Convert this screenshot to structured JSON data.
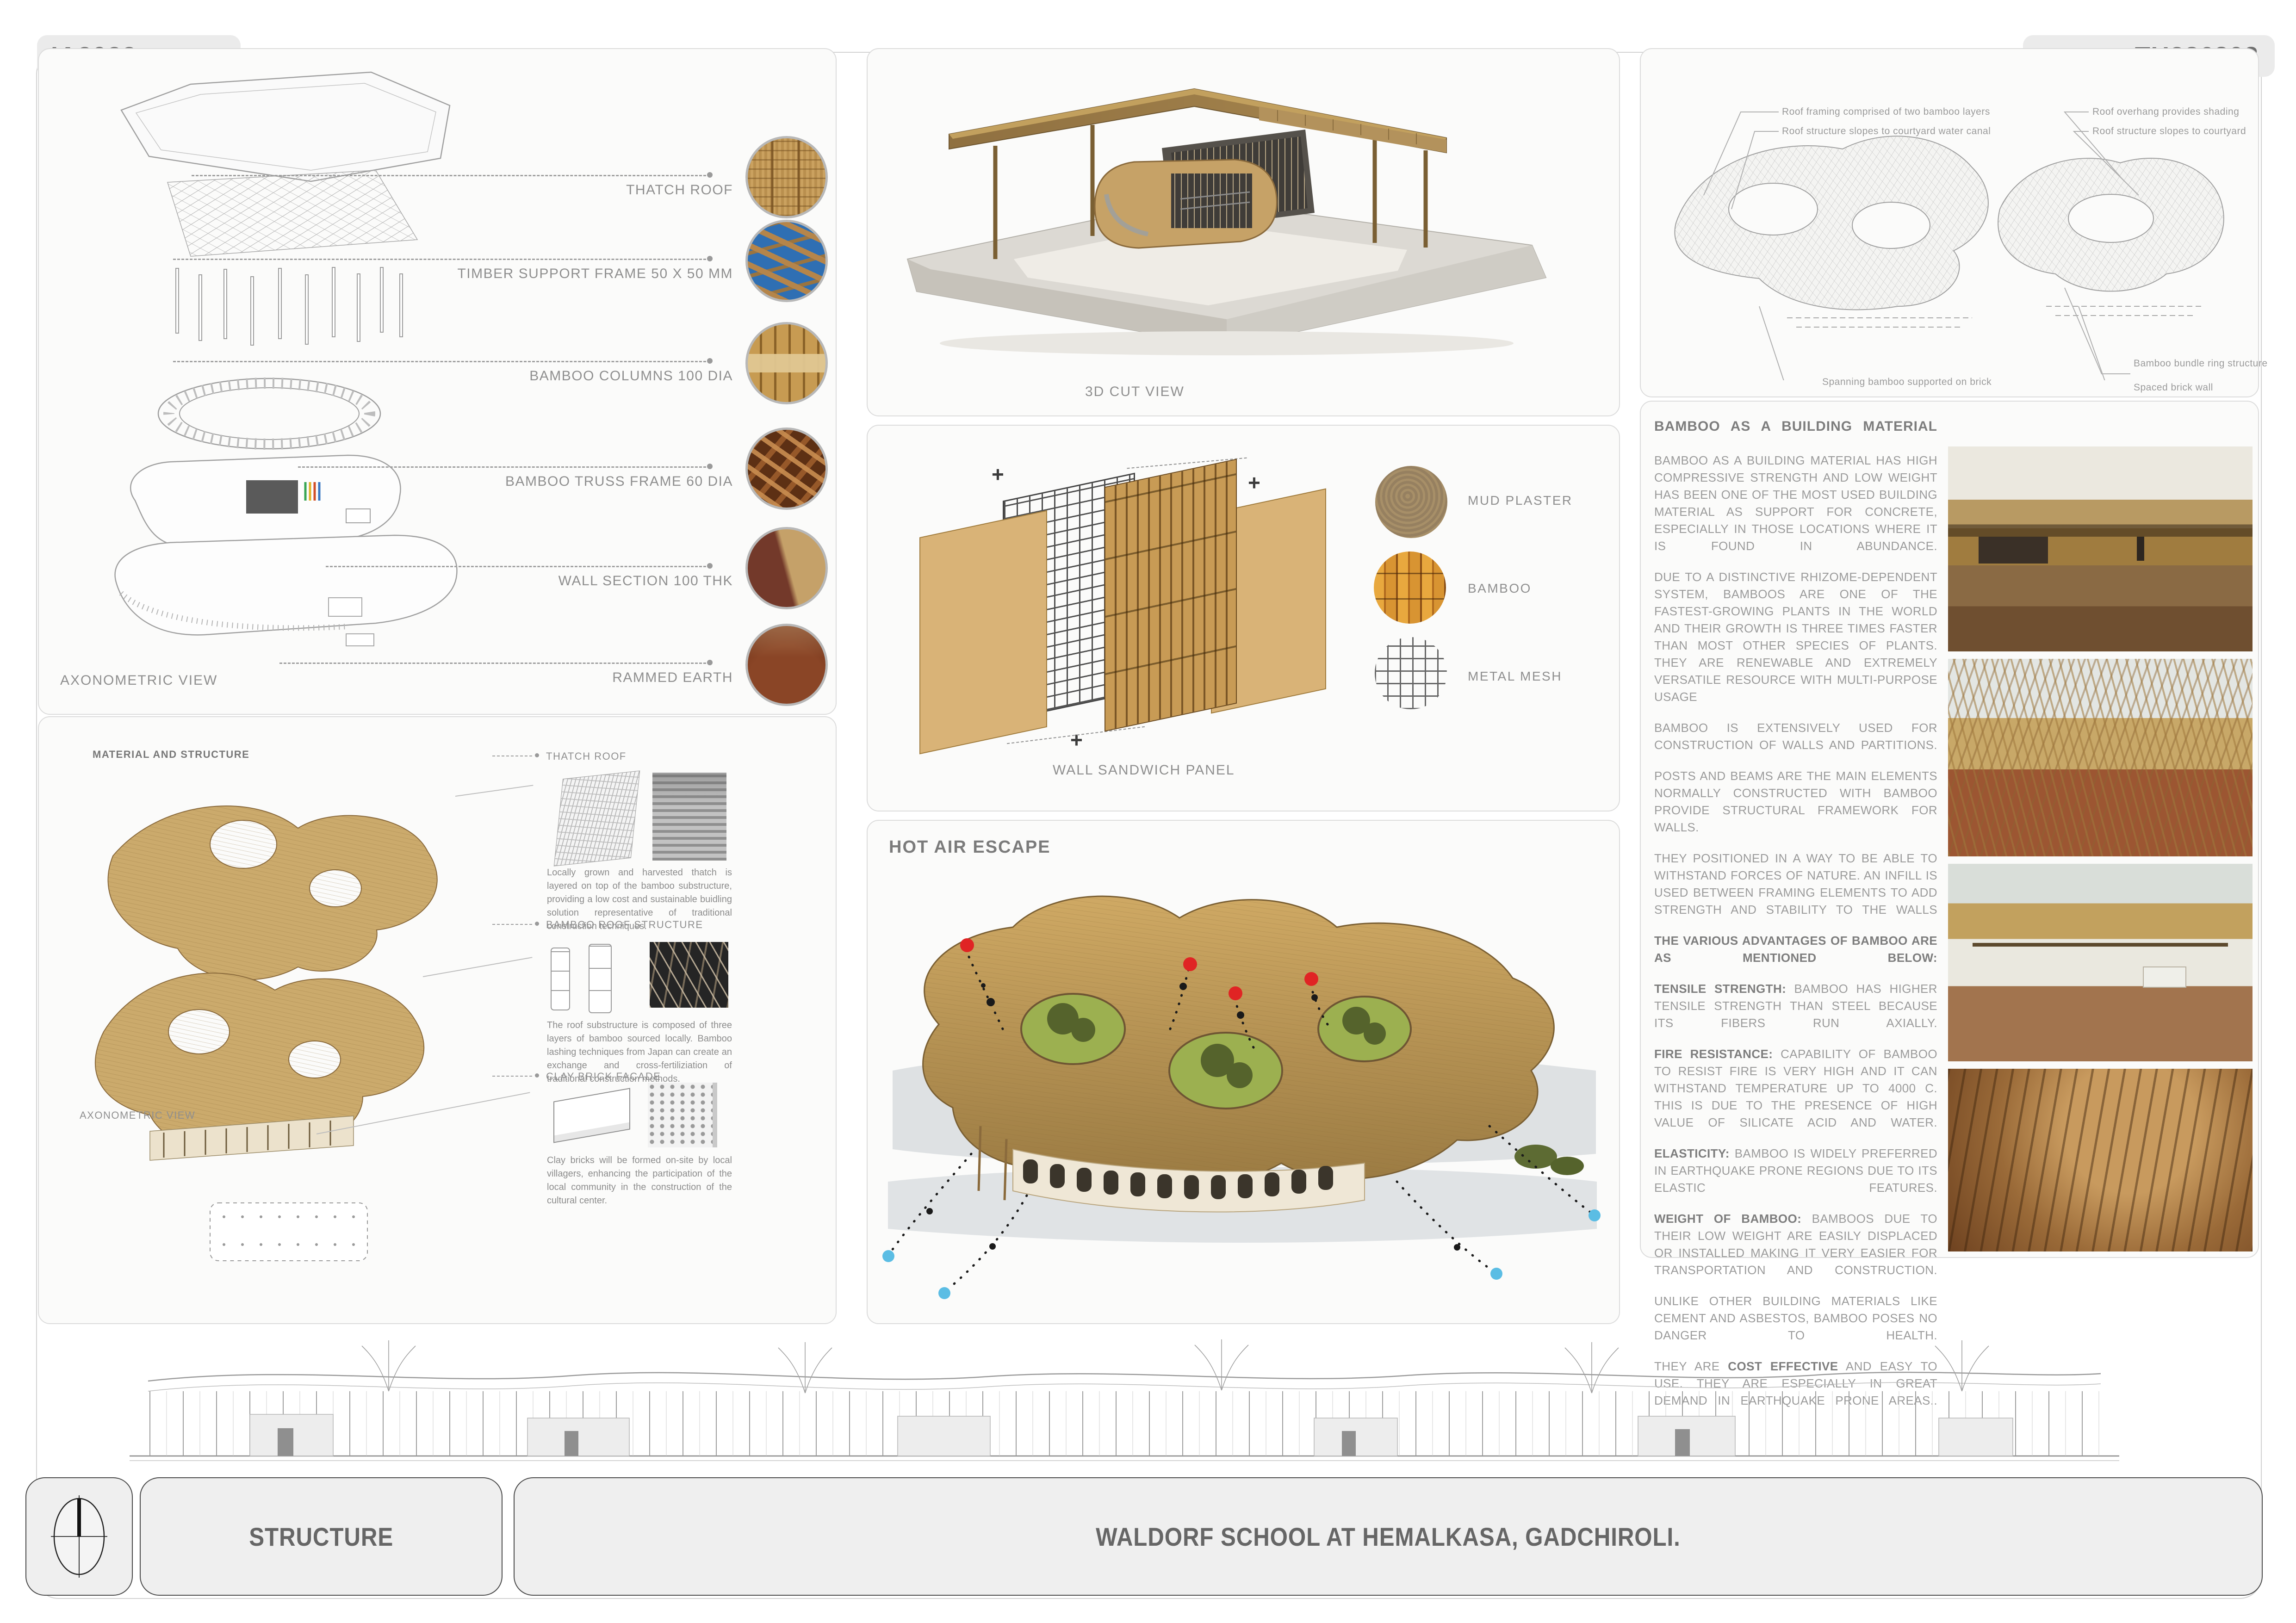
{
  "header": {
    "left_code": "IA2022",
    "right_code": "TU286303"
  },
  "footer": {
    "theme": "STRUCTURE",
    "project_title": "WALDORF SCHOOL AT HEMALKASA, GADCHIROLI."
  },
  "axon_panel": {
    "caption": "AXONOMETRIC VIEW",
    "labels": [
      {
        "label": "THATCH ROOF",
        "swatch": "thatch-photo"
      },
      {
        "label": "TIMBER SUPPORT FRAME 50 X 50 MM",
        "swatch": "timber-frame-photo"
      },
      {
        "label": "BAMBOO COLUMNS  100 DIA",
        "swatch": "bamboo-columns-photo"
      },
      {
        "label": "BAMBOO TRUSS FRAME 60 DIA",
        "swatch": "bamboo-truss-photo"
      },
      {
        "label": "WALL SECTION 100 THK",
        "swatch": "wall-section-photo"
      },
      {
        "label": "RAMMED EARTH",
        "swatch": "rammed-earth-photo"
      }
    ]
  },
  "material_panel": {
    "heading": "MATERIAL AND STRUCTURE",
    "caption": "AXONOMETRIC VIEW",
    "items": [
      {
        "label": "THATCH ROOF",
        "para": "Locally grown and harvested thatch is layered on top of the bamboo substructure, providing a low cost and sustainable buidling solution representative of traditional construction techniques."
      },
      {
        "label": "BAMBOO ROOF STRUCTURE",
        "para": "The roof substructure is composed of three layers of bamboo sourced locally. Bamboo lashing techniques from Japan can create an exchange and cross-fertiliziation of traditional construction methods."
      },
      {
        "label": "CLAY BRICK FACADE",
        "para": "Clay bricks will be formed on-site by local villagers, enhancing the participation of the local community in the construction of the cultural center."
      }
    ]
  },
  "cut_panel": {
    "caption": "3D CUT VIEW"
  },
  "wall_panel": {
    "caption": "WALL SANDWICH PANEL",
    "materials": [
      {
        "label": "MUD PLASTER"
      },
      {
        "label": "BAMBOO"
      },
      {
        "label": "METAL MESH"
      }
    ]
  },
  "hot_air_panel": {
    "title": "HOT AIR ESCAPE"
  },
  "roof_diagram_panel": {
    "annotations": [
      "Roof framing comprised of two bamboo layers",
      "Roof structure slopes to courtyard water canal",
      "Roof overhang provides shading",
      "Roof structure slopes to courtyard",
      "Spanning bamboo supported on brick",
      "Bamboo bundle ring structure",
      "Spaced brick wall"
    ]
  },
  "bamboo_text_panel": {
    "heading": "BAMBOO AS A BUILDING MATERIAL",
    "paragraphs": [
      {
        "text": "BAMBOO AS A BUILDING MATERIAL HAS HIGH COMPRESSIVE STRENGTH AND LOW WEIGHT HAS BEEN ONE OF THE MOST USED BUILDING MATERIAL AS SUPPORT FOR CONCRETE, ESPECIALLY IN THOSE LOCATIONS WHERE IT IS FOUND IN ABUNDANCE."
      },
      {
        "text": "DUE TO A DISTINCTIVE RHIZOME-DEPENDENT SYSTEM, BAMBOOS ARE ONE OF THE FASTEST-GROWING PLANTS IN THE WORLD AND THEIR GROWTH IS THREE TIMES FASTER THAN MOST OTHER SPECIES OF PLANTS. THEY ARE RENEWABLE AND EXTREMELY VERSATILE RESOURCE WITH MULTI-PURPOSE USAGE"
      },
      {
        "text": "BAMBOO IS EXTENSIVELY USED FOR CONSTRUCTION OF WALLS AND PARTITIONS."
      },
      {
        "text": "POSTS AND BEAMS ARE THE MAIN ELEMENTS NORMALLY CONSTRUCTED WITH BAMBOO PROVIDE STRUCTURAL FRAMEWORK FOR WALLS."
      },
      {
        "text": "THEY POSITIONED IN A WAY TO BE ABLE TO WITHSTAND FORCES OF NATURE. AN INFILL IS USED BETWEEN FRAMING ELEMENTS TO ADD STRENGTH AND STABILITY TO THE WALLS"
      },
      {
        "lead": "THE VARIOUS ADVANTAGES OF BAMBOO ARE AS MENTIONED BELOW:",
        "text": ""
      },
      {
        "lead": "TENSILE STRENGTH:",
        "text": " BAMBOO HAS HIGHER TENSILE STRENGTH THAN STEEL BECAUSE ITS FIBERS RUN AXIALLY."
      },
      {
        "lead": "FIRE RESISTANCE:",
        "text": " CAPABILITY OF BAMBOO TO RESIST FIRE IS VERY HIGH AND IT CAN WITHSTAND TEMPERATURE UP TO 4000 C. THIS IS DUE TO THE PRESENCE OF HIGH VALUE OF SILICATE ACID AND WATER."
      },
      {
        "lead": "ELASTICITY:",
        "text": " BAMBOO IS WIDELY PREFERRED IN EARTHQUAKE PRONE REGIONS DUE TO ITS ELASTIC FEATURES."
      },
      {
        "lead": "WEIGHT OF BAMBOO:",
        "text": " BAMBOOS DUE TO THEIR LOW WEIGHT ARE EASILY DISPLACED OR INSTALLED MAKING IT VERY EASIER FOR TRANSPORTATION AND CONSTRUCTION."
      },
      {
        "text": "UNLIKE OTHER BUILDING MATERIALS LIKE CEMENT AND ASBESTOS, BAMBOO POSES NO DANGER TO HEALTH."
      },
      {
        "pre": "THEY ARE ",
        "lead": "COST EFFECTIVE",
        "text": " AND EASY TO USE. THEY ARE ESPECIALLY IN GREAT DEMAND IN EARTHQUAKE PRONE AREAS.."
      }
    ],
    "photos": [
      "school-exterior-photo",
      "gridshell-construction-photo",
      "bamboo-roof-building-photo",
      "interior-bamboo-roof-photo"
    ]
  },
  "colors": {
    "roof_tan": "#c9a25e",
    "hot_air_red": "#e02424",
    "cool_air_blue": "#5bbde4",
    "courtyard_green": "#9cb050",
    "text_gray": "#9b9b9b"
  }
}
